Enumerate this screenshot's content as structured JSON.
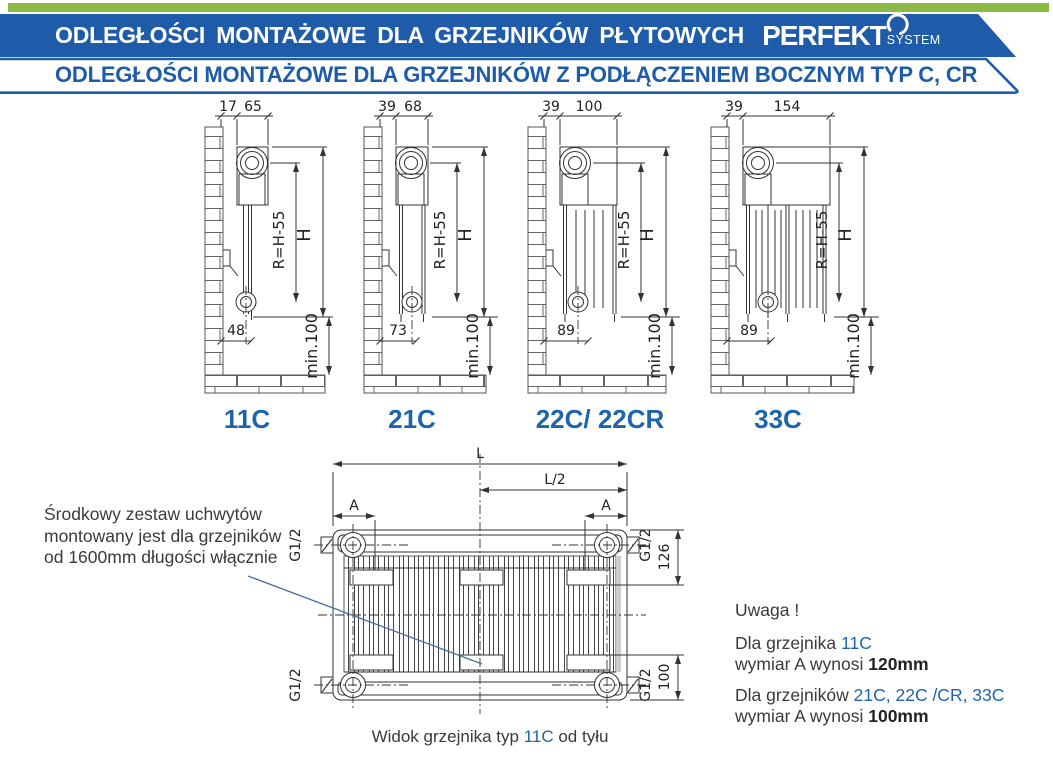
{
  "colors": {
    "accent_green": "#8cba44",
    "brand_blue": "#1e5caa",
    "type_label_blue": "#1d64ad",
    "line": "#333333",
    "text": "#3a3a3a"
  },
  "header": {
    "title": "ODLEGŁOŚCI MONTAŻOWE DLA GRZEJNIKÓW PŁYTOWYCH",
    "logo_brand": "PERFEKT",
    "logo_sub": "SYSTEM",
    "subtitle": "ODLEGŁOŚCI MONTAŻOWE DLA GRZEJNIKÓW Z PODŁĄCZENIEM BOCZNYM TYP C, CR"
  },
  "dims_common": {
    "r": "R=H-55",
    "h": "H",
    "min": "min.100",
    "g": "G1/2"
  },
  "diagrams": [
    {
      "label": "11C",
      "wall_offset": "17",
      "depth": "65",
      "bottom": "48"
    },
    {
      "label": "21C",
      "wall_offset": "39",
      "depth": "68",
      "bottom": "73"
    },
    {
      "label": "22C/ 22CR",
      "wall_offset": "39",
      "depth": "100",
      "bottom": "89"
    },
    {
      "label": "33C",
      "wall_offset": "39",
      "depth": "154",
      "bottom": "89"
    }
  ],
  "rear_view": {
    "L": "L",
    "L_half": "L/2",
    "A": "A",
    "h126": "126",
    "h100": "100",
    "caption_prefix": "Widok grzejnika typ ",
    "caption_type": "11C",
    "caption_suffix": " od tyłu"
  },
  "note_left": {
    "line1": "Środkowy zestaw uchwytów",
    "line2": "montowany jest dla grzejników",
    "line3": "od 1600mm długości włącznie"
  },
  "note_right": {
    "title": "Uwaga !",
    "p1_prefix": "Dla grzejnika ",
    "p1_types": "11C",
    "p1_l2_prefix": "wymiar A wynosi ",
    "p1_value": "120mm",
    "p2_prefix": "Dla grzejników ",
    "p2_types": "21C, 22C /CR, 33C",
    "p2_l2_prefix": "wymiar A wynosi ",
    "p2_value": "100mm"
  }
}
